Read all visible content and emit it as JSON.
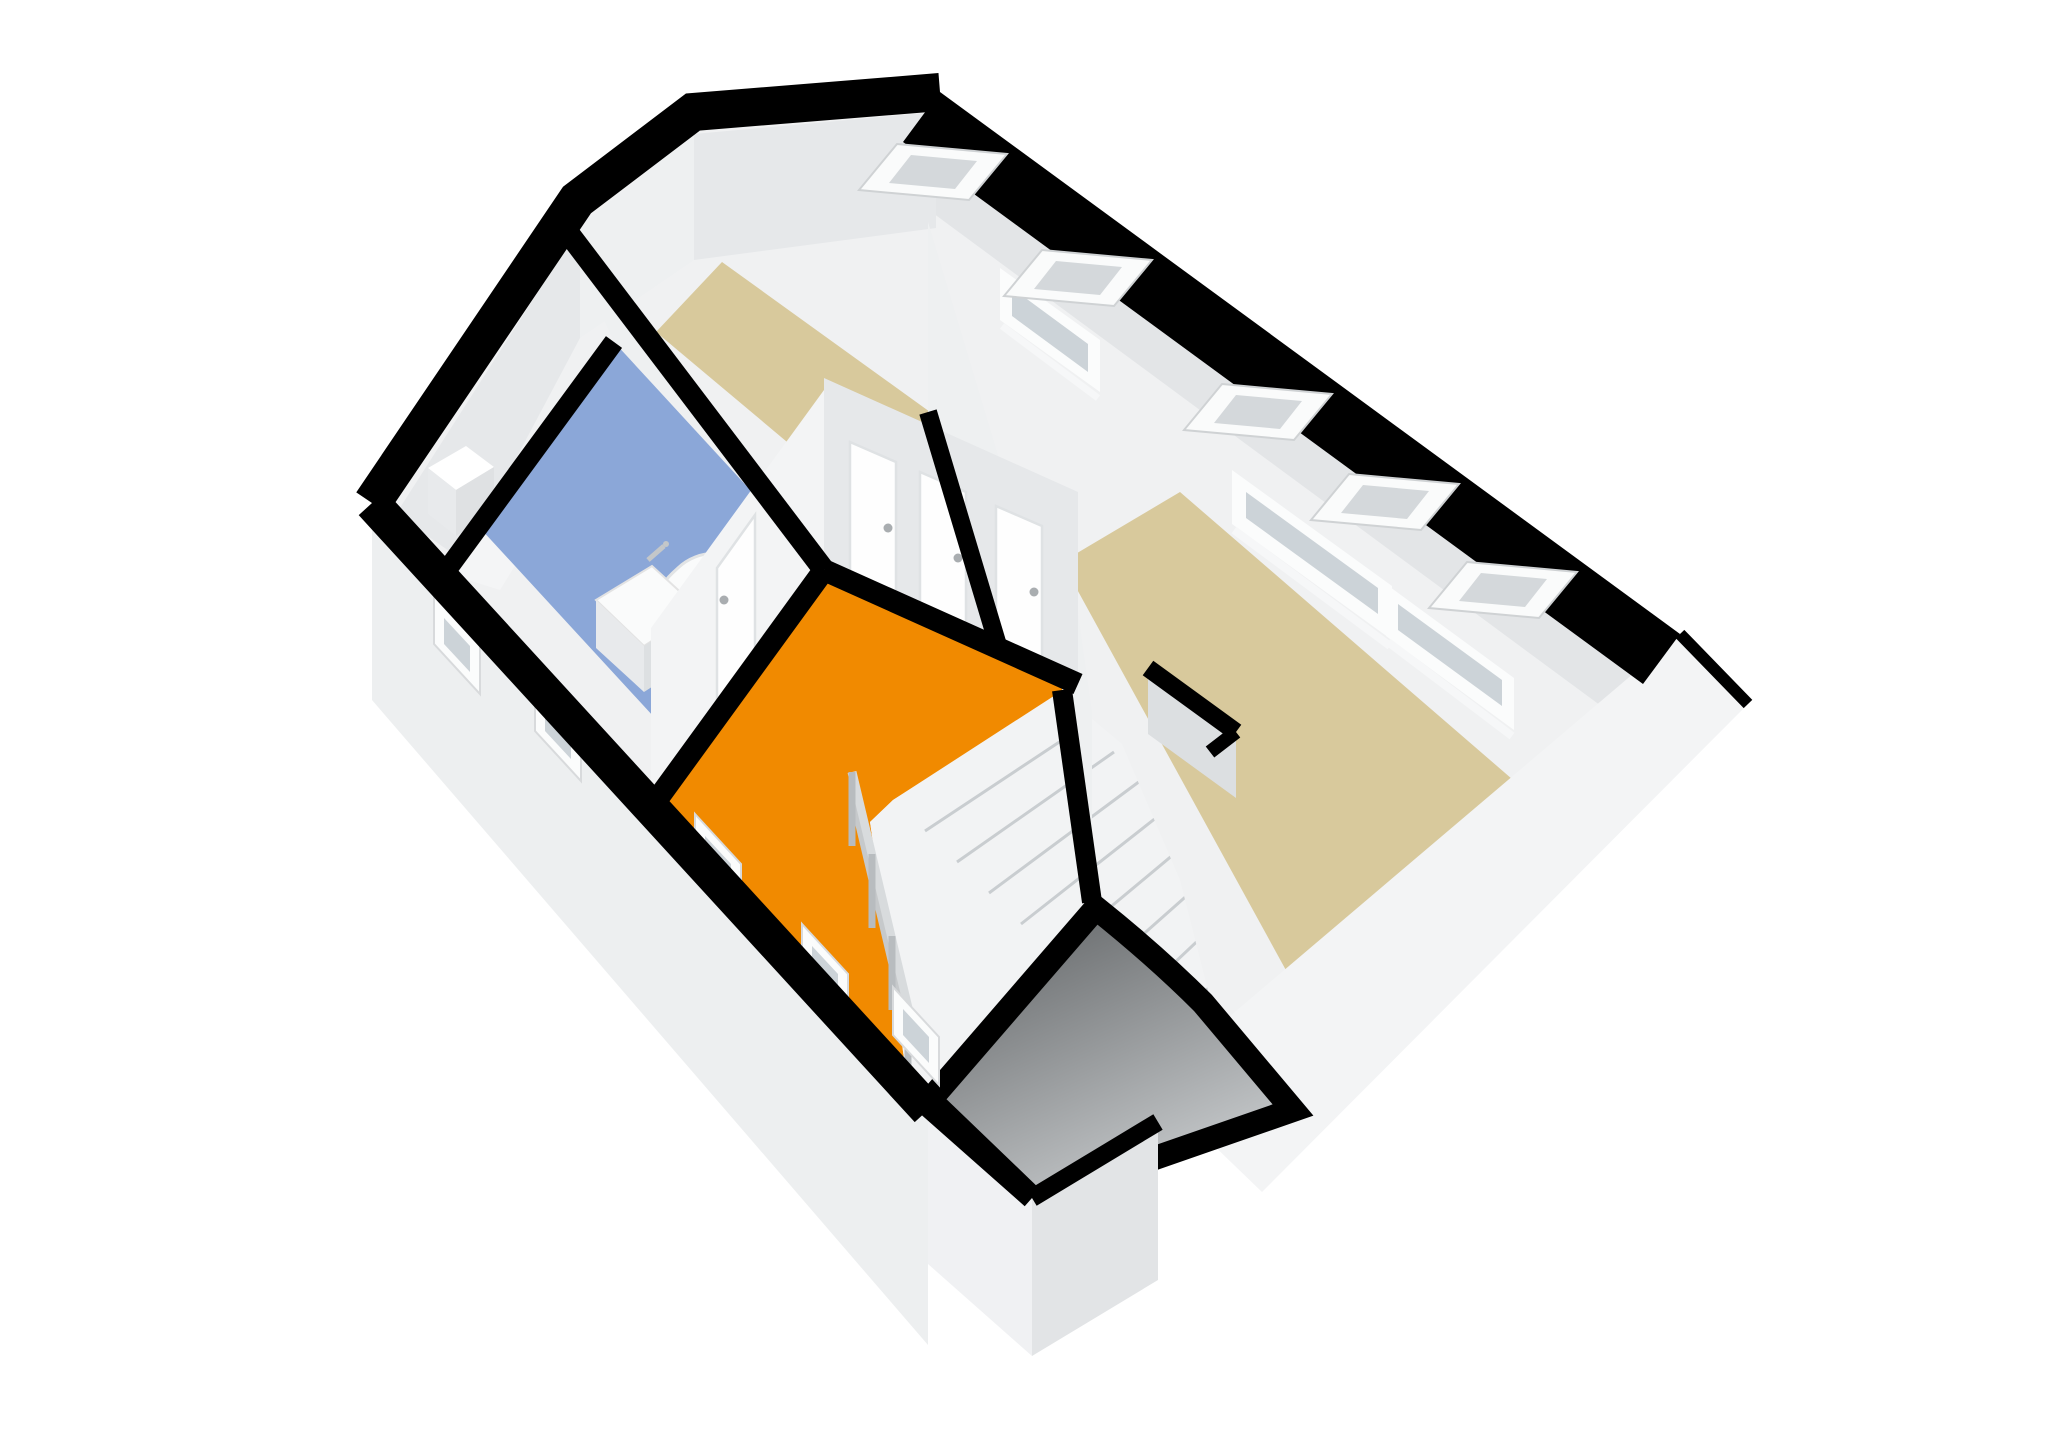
{
  "view": {
    "type": "3d-floorplan-cutaway-render",
    "storey": "attic floor",
    "projection": "axonometric from above",
    "background": "#ffffff"
  },
  "colors": {
    "wall_cut": "#000000",
    "interior_base": "#f0f1f2",
    "back_wall": "#e3e5e7",
    "wall_face_light": "#eef0f1",
    "wall_face_mid": "#e6e8ea",
    "wall_face_dark": "#dcdfe1",
    "facade": "#edeff0",
    "gable_wall": "#f3f4f5",
    "protrusion_left": "#f0f1f3",
    "protrusion_right": "#e2e4e6",
    "floor_tan": "#d8c99c",
    "floor_orange": "#f18a00",
    "floor_blue": "#8ba7d8",
    "floor_light": "#f4f5f6",
    "stair_fill": "#f2f3f4",
    "tread_line": "#c9cdd0",
    "dark_roof_top": "#595c5e",
    "dark_roof_bottom": "#c6c9cb",
    "skylight_frame": "#fafbfb",
    "skylight_glass": "#d4d8db",
    "window_frame": "#fbfcfc",
    "window_glass": "#ccd3d8",
    "door": "#fefefe",
    "door_frame": "#dfe2e4",
    "door_handle": "#a9adb0",
    "fixture": "#fafbfb",
    "fixture_inner": "#f0f1f2",
    "fixture_shade": "#e8eaec",
    "fixture_side": "#dde0e2",
    "chimney_top": "#ffffff",
    "chimney_front": "#e8eaec",
    "chimney_side": "#dfe1e3"
  },
  "rooms": [
    {
      "id": "room-west",
      "floor": "light grey",
      "features": [
        "chimney"
      ]
    },
    {
      "id": "bathroom",
      "floor": "blue",
      "fixtures": [
        "bathtub",
        "washbasin"
      ]
    },
    {
      "id": "bedroom-center",
      "floor": "tan",
      "openings": [
        "dormer window",
        "skylight x2"
      ]
    },
    {
      "id": "landing",
      "floor": "orange",
      "features": [
        "staircase",
        "railing",
        "doors x4"
      ]
    },
    {
      "id": "bedroom-east",
      "floor": "tan",
      "openings": [
        "dormer window x2",
        "skylight x3"
      ]
    }
  ],
  "openings": {
    "skylights": 5,
    "dormer_windows": 3,
    "facade_windows": 5,
    "interior_doors": 4
  },
  "staircase": {
    "treads_visible": 8,
    "railing_posts": 4,
    "descends": "to lower storey at front of house"
  }
}
